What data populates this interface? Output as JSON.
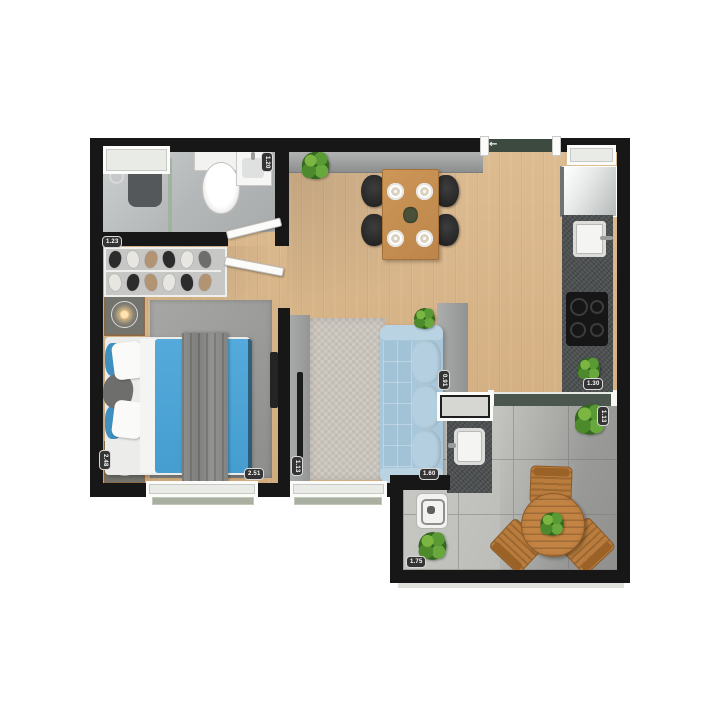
{
  "document": {
    "kind": "apartment-floor-plan",
    "style": "top-down 3D render, unfurnished labels, furnished rooms",
    "rooms_inventory": {
      "bathroom": [
        "window",
        "shower-area",
        "shower-glass-partition",
        "toilet",
        "vanity-sink"
      ],
      "bedroom": [
        "shoe-rack",
        "double-bed-blue",
        "nightstand-with-lamp-top",
        "nightstand-with-lamp-bottom",
        "gray-rug",
        "wall-tv",
        "window"
      ],
      "living_dining": [
        "entry-mat",
        "sideboard",
        "potted-plant",
        "dining-table-with-4-black-chairs-and-plates",
        "tv-panel",
        "textured-rug",
        "blue-sofa",
        "half-wall-console",
        "potted-plant"
      ],
      "kitchen": [
        "window",
        "fridge",
        "granite-counter",
        "sink",
        "4-burner-cooktop",
        "potted-plant"
      ],
      "balcony": [
        "sliding-door-track",
        "service-pass-window",
        "laundry-tank-counter",
        "floor-drain-box",
        "round-wood-table-with-plant",
        "three-wood-chairs",
        "potted-plant-top",
        "potted-plant-bottom"
      ]
    }
  },
  "dims": {
    "bathroom": "1.23",
    "bath_sink": "1.20",
    "bedroom_side": "2.48",
    "bedroom_front": "2.51",
    "living_side": "1.13",
    "sofa_front": "1.60",
    "divider": "0.91",
    "kitchen": "1.30",
    "balcony_side": "1.13",
    "balcony_front": "1.75"
  },
  "icons": {
    "entry_arrow": "←"
  },
  "colors": {
    "wall": "#171717",
    "wood_floor": "#d7b588",
    "bathroom_floor": "#b9bcbd",
    "balcony_tile": "#c2c3bf",
    "granite_counter": "#4d5051",
    "sofa_blue": "#a9c7da",
    "bed_blue": "#4aa3d6",
    "dining_table_wood": "#c89254",
    "balcony_wood": "#b97c3c",
    "plant_green": "#4c8a2b",
    "entry_mat_green": "#3c4a40",
    "bedroom_rug": "#9b9b99",
    "living_rug": "#c9c4bd"
  }
}
